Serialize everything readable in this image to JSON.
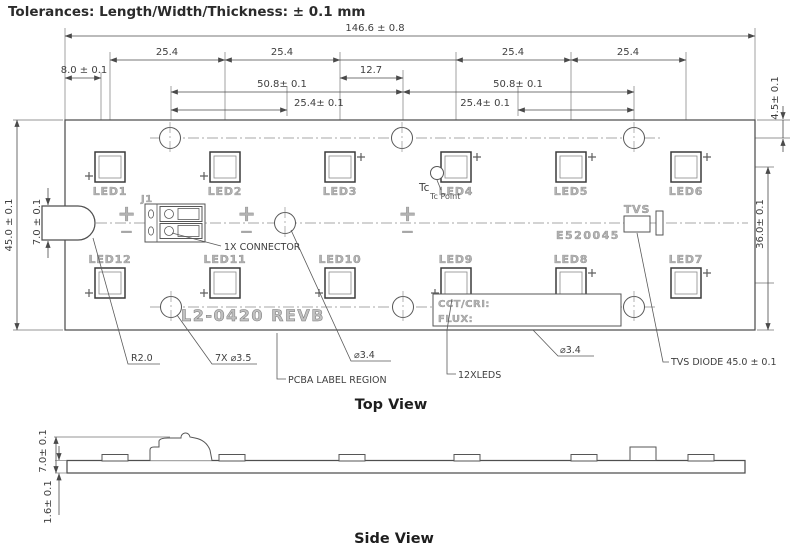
{
  "tolerance_note": "Tolerances: Length/Width/Thickness: ± 0.1 mm",
  "views": {
    "top": "Top View",
    "side": "Side View"
  },
  "dims": {
    "overall_width": "146.6 ± 0.8",
    "led_pitch_1": "25.4",
    "led_pitch_2": "25.4",
    "led_pitch_3": "25.4",
    "led_pitch_4": "25.4",
    "edge_to_led": "8.0 ± 0.1",
    "half_pitch": "12.7",
    "hole_span_left": "50.8± 0.1",
    "hole_span_right": "50.8± 0.1",
    "hole_pos_left": "25.4± 0.1",
    "hole_pos_right": "25.4± 0.1",
    "top_edge_to_hole": "4.5± 0.1",
    "overall_height": "45.0 ± 0.1",
    "tab_height": "7.0 ± 0.1",
    "led_row_pitch": "25.4",
    "led_to_bottom_edge": "36.0± 0.1",
    "led7_to_bottom_edge": "9.8",
    "side_component_height": "7.0± 0.1",
    "pcb_thickness": "1.6± 0.1"
  },
  "leds": [
    {
      "label": "LED1"
    },
    {
      "label": "LED2"
    },
    {
      "label": "LED3"
    },
    {
      "label": "LED4"
    },
    {
      "label": "LED5"
    },
    {
      "label": "LED6"
    },
    {
      "label": "LED7"
    },
    {
      "label": "LED8"
    },
    {
      "label": "LED9"
    },
    {
      "label": "LED10"
    },
    {
      "label": "LED11"
    },
    {
      "label": "LED12"
    }
  ],
  "silkscreen": {
    "j1": "J1",
    "plus": "+",
    "minus": "−",
    "tvs": "TVS",
    "ul_number": "E520045",
    "board_label": "L2-0420 REVB",
    "cct": "CCT/CRI:",
    "flux": "FLUX:"
  },
  "callouts": {
    "connector": "1X CONNECTOR",
    "tc": "Tc",
    "tc_point": "Tc Point",
    "corner_radius": "R2.0",
    "mounting_holes": "7X ⌀3.5",
    "pcba_label": "PCBA LABEL REGION",
    "hole_dia_left": "⌀3.4",
    "leds_count": "12XLEDS",
    "hole_dia_right": "⌀3.4",
    "tvs_diode": "TVS DIODE 45.0 ± 0.1"
  },
  "colors": {
    "line": "#4a4a4a",
    "silkscreen": "#9e9e9e",
    "background": "#ffffff"
  }
}
